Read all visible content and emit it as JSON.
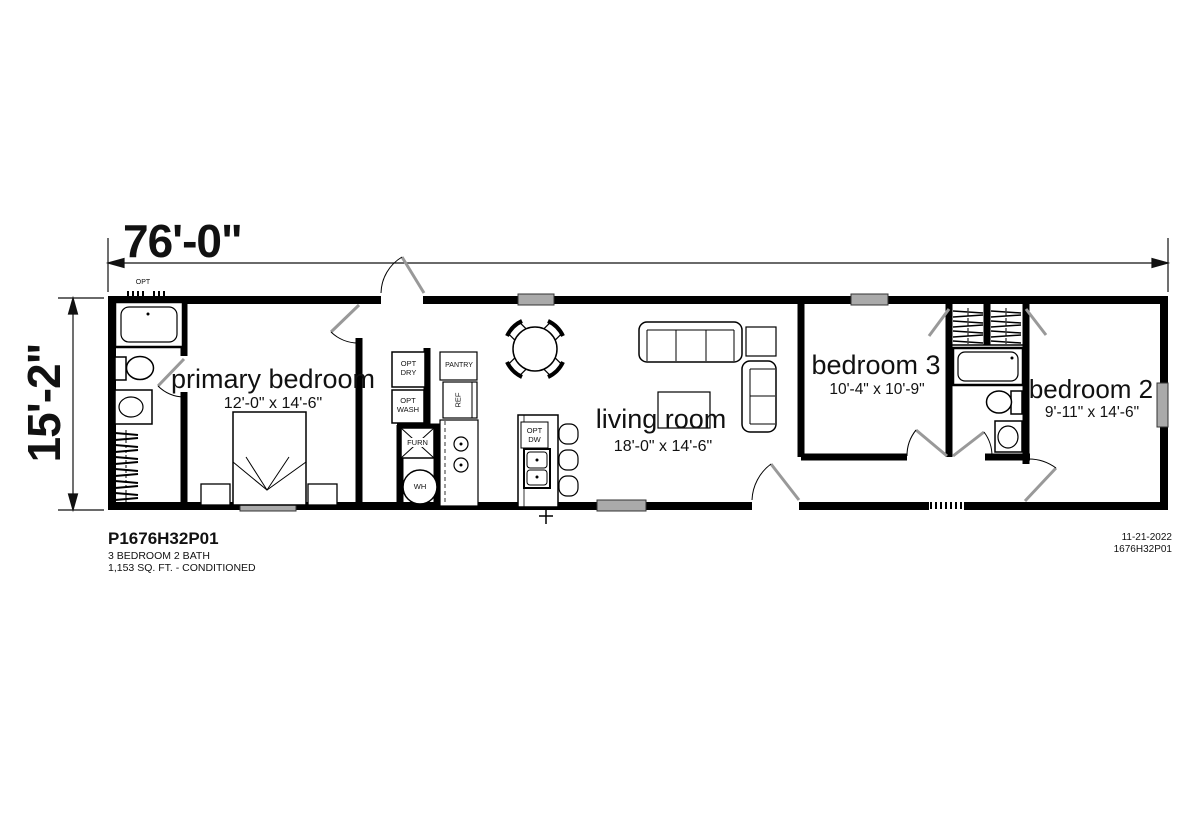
{
  "plan": {
    "overall_width": "76'-0\"",
    "overall_height": "15'-2\""
  },
  "rooms": [
    {
      "name": "primary bedroom",
      "size": "12'-0\" x 14'-6\""
    },
    {
      "name": "living room",
      "size": "18'-0\" x 14'-6\""
    },
    {
      "name": "bedroom 3",
      "size": "10'-4\" x 10'-9\""
    },
    {
      "name": "bedroom 2",
      "size": "9'-11\" x 14'-6\""
    }
  ],
  "labels": {
    "opt_dryer": "OPT\nDRY",
    "opt_washer": "OPT\nWASH",
    "furnace": "FURN",
    "water_heater": "WH",
    "pantry": "PANTRY",
    "refrigerator": "REF",
    "opt_dishwasher": "OPT\nDW",
    "opt_window": "OPT"
  },
  "footer": {
    "plan_number": "P1676H32P01",
    "description": "3 BEDROOM 2 BATH",
    "area": "1,153 SQ. FT. - CONDITIONED",
    "date": "11-21-2022",
    "drawing_number": "1676H32P01"
  },
  "colors": {
    "wall": "#000000",
    "window_fill": "#aaaaaa",
    "door_leaf": "#999999",
    "background": "#ffffff",
    "text": "#111111"
  }
}
